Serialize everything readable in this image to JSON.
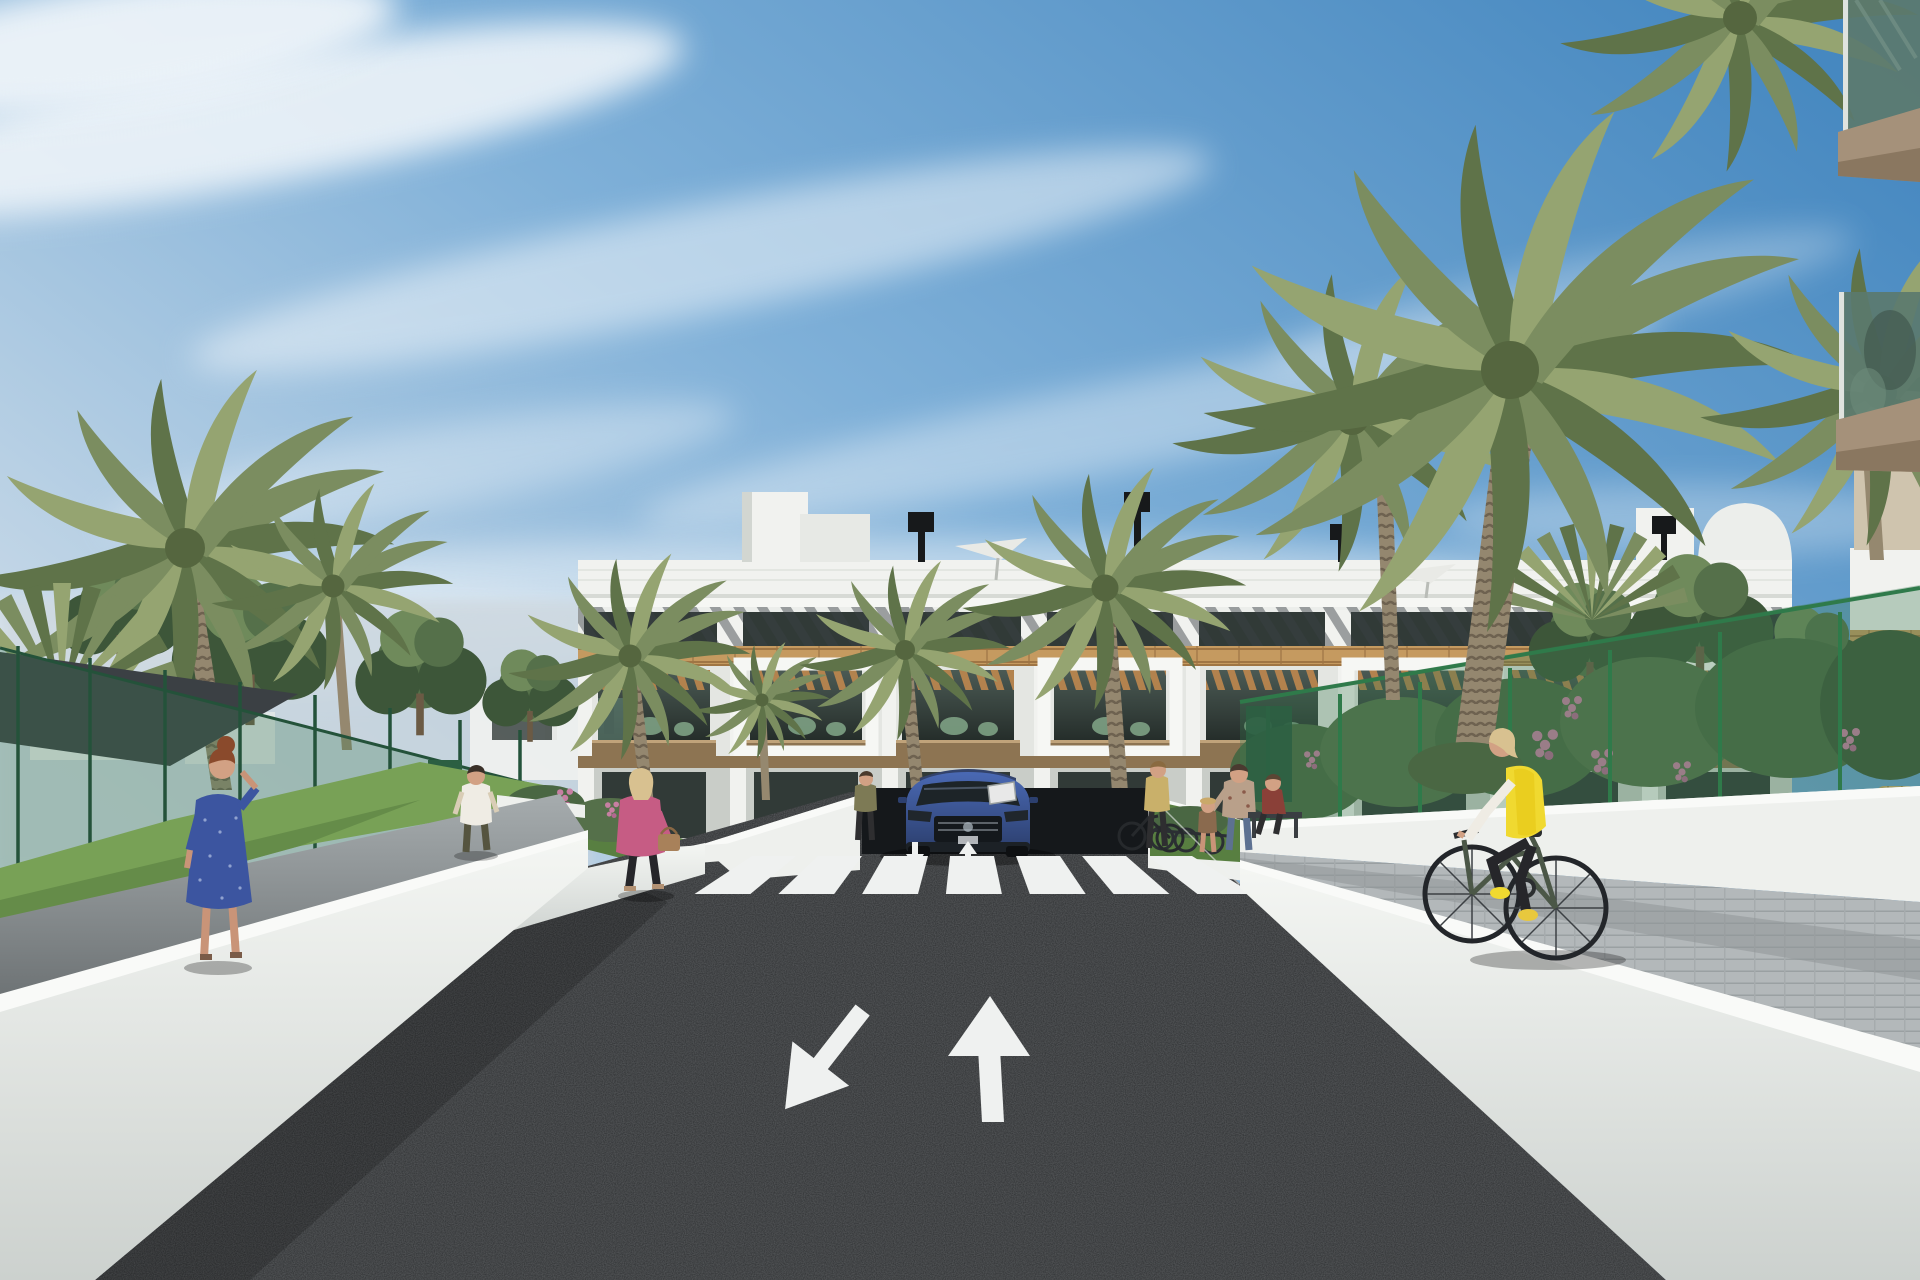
{
  "scene": {
    "title": "Architectural rendering: street approach to a modern Mediterranean apartment complex",
    "description": "3D render of a new-build three-storey white apartment block with wood-clad bands, slatted roof frieze and pergola balconies. A dark asphalt driveway with a zebra crossing and two painted lane arrows leads to the building. Palm trees, green mesh fences, white retaining walls, pedestrians, a cyclist in a yellow vest and a blue SUV complete the scene.",
    "time_of_day": "daytime, clear blue sky with wispy clouds",
    "visible_text": ""
  },
  "objects": {
    "building": {
      "label": "apartment-block",
      "storeys_visible": 3,
      "features": [
        "white parapet with roof terraces",
        "diagonal slat frieze",
        "wood brick band",
        "white pergola balcony frames",
        "roof umbrellas",
        "black chimney vents",
        "white stair towers",
        "barrel-vault roof"
      ]
    },
    "road_markings": {
      "crosswalk_stripes": 7,
      "large_lane_arrows": [
        "down-left (oncoming lane)",
        "up (departing lane)"
      ],
      "small_lane_arrows": 2
    },
    "vehicles": [
      {
        "label": "blue-suv",
        "color_key": "car_blue",
        "position": "parked at building entrance, facing viewer"
      }
    ],
    "people": [
      {
        "label": "woman-blue-dress",
        "detail": "auburn hair, phone to ear, left walkway"
      },
      {
        "label": "man-white-shirt",
        "detail": "walking away on left garden path"
      },
      {
        "label": "woman-pink-jacket",
        "detail": "blonde, tan handbag, walking near crosswalk"
      },
      {
        "label": "person-at-entrance",
        "detail": "standing by entrance wall"
      },
      {
        "label": "woman-with-bicycle",
        "detail": "standing right of crosswalk"
      },
      {
        "label": "mother-and-child",
        "detail": "right of entrance"
      },
      {
        "label": "seated-person-on-bench",
        "detail": "far right garden"
      },
      {
        "label": "couple-on-balcony",
        "detail": "first-floor balcony right wing"
      },
      {
        "label": "cyclist-yellow-vest",
        "detail": "riding away on right-hand paved ramp"
      }
    ],
    "vegetation": [
      "date palms",
      "fan palms",
      "leafy trees",
      "flowering bushes pink",
      "flowering bushes orange",
      "lawn strips"
    ],
    "structures": [
      "green mesh fence",
      "dark shade sail",
      "white retaining walls",
      "white planter walls",
      "bike racks",
      "wicker chairs"
    ]
  },
  "colors": {
    "sky_top": "#3f83bd",
    "sky_mid": "#7fb0d8",
    "sky_low": "#cfdde9",
    "cloud": "#eef4f9",
    "building_white": "#f1f2ef",
    "building_shade": "#dcdfda",
    "parapet_line": "#d7dad5",
    "frieze_dark": "#4a5156",
    "window_dark": "#313a37",
    "wood_band": "#c59a60",
    "wood_dark": "#9f7544",
    "pergola_wood": "#b9854e",
    "fascia_wood": "#8d7452",
    "furniture_green": "#7ea184",
    "glass_balcony": "#5b7a6e",
    "slab_tan": "#a5917a",
    "palm_dark": "#5f7349",
    "palm_mid": "#7b8d60",
    "palm_light": "#95a471",
    "trunk": "#95886f",
    "trunk_dark": "#6e6250",
    "tree_dark": "#3d5639",
    "tree_mid": "#55704a",
    "tree_light": "#6f8a5b",
    "grass": "#78a156",
    "grass_shade": "#587f41",
    "bush_green": "#4a6743",
    "flower_pink": "#c77fa2",
    "flower_orange": "#d07a36",
    "asphalt": "#2d2f31",
    "asphalt_light": "#3a3d40",
    "marking_white": "#eff1f0",
    "wall_white": "#eef0ed",
    "wall_top": "#f9faf8",
    "wall_shade": "#c3c8c5",
    "path_grey": "#979da0",
    "path_light": "#b3b8ba",
    "fence_green": "#24523a",
    "fence_mesh": "#3a7a52",
    "sail_dark": "#3b4044",
    "car_blue": "#3d5a9c",
    "car_glass": "#1d2428",
    "skin": "#d2a184",
    "hair_blonde": "#d8c190",
    "hair_auburn": "#8a4a2c",
    "dress_blue": "#3c55a0",
    "jacket_pink": "#c65c84",
    "vest_yellow": "#f0d930",
    "pants_dark": "#26262a",
    "shirt_white": "#efece4",
    "bike_green": "#4b5747",
    "bag_tan": "#a8815a",
    "shoe_yellow": "#e8c83e"
  }
}
